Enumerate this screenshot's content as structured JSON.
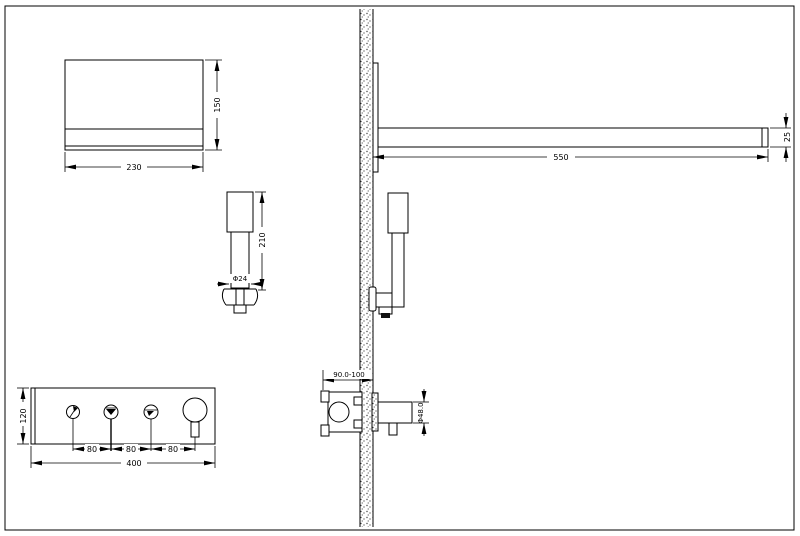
{
  "drawing": {
    "background": "#ffffff",
    "line_color": "#000000",
    "views": {
      "shower_head": {
        "width_dim": "230",
        "height_dim": "150"
      },
      "hand_shower": {
        "length_dim": "210",
        "diameter_dim": "Φ24"
      },
      "shower_arm": {
        "length_dim": "550",
        "end_dim": "25"
      },
      "mixer_valve": {
        "depth_dim": "90.0-100",
        "knob_dim": "Φ48.0"
      },
      "control_panel": {
        "height_dim": "120",
        "width_dim": "400",
        "spacing_dims": [
          "80",
          "80",
          "80"
        ]
      }
    },
    "icons": {
      "button1": "handshower-mode-icon",
      "button2": "rainfall-mode-icon",
      "button3": "spout-mode-icon",
      "knob": "temperature-knob"
    }
  }
}
